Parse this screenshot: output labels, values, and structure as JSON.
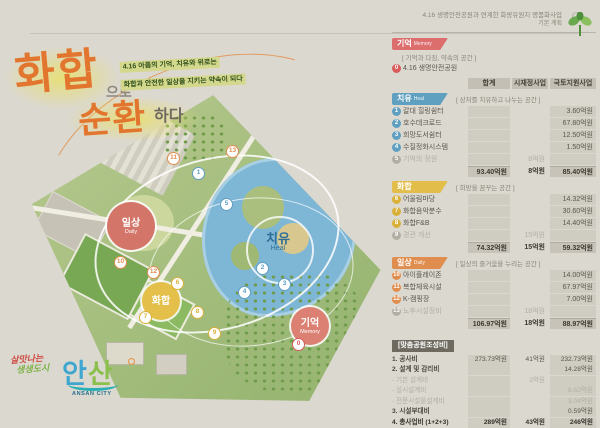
{
  "title": {
    "word1": "화합",
    "particle1": "으로",
    "word2": "순환",
    "particle2": "하다",
    "subtitle_line1": "4.16 아픔의 기억, 치유와 위로는",
    "subtitle_line2": "화합과 안전한 일상을 지키는 약속이 되다"
  },
  "header_note": {
    "line1": "4.16 생명안전공원과 연계한 화랑유원지 명품화사업",
    "line2": "기본 계획"
  },
  "map": {
    "zones": {
      "daily": {
        "label": "일상",
        "eng": "Daily"
      },
      "heal": {
        "label": "치유",
        "eng": "Heal"
      },
      "unity": {
        "label": "화합",
        "eng": ""
      },
      "memory": {
        "label": "기억",
        "eng": "Memory"
      }
    },
    "markers": [
      {
        "n": "0",
        "c": "#d85c5c",
        "x": 297,
        "y": 343
      },
      {
        "n": "1",
        "c": "#5f9fc0",
        "x": 197,
        "y": 172
      },
      {
        "n": "2",
        "c": "#5f9fc0",
        "x": 261,
        "y": 267
      },
      {
        "n": "3",
        "c": "#5f9fc0",
        "x": 283,
        "y": 283
      },
      {
        "n": "4",
        "c": "#5f9fc0",
        "x": 243,
        "y": 291
      },
      {
        "n": "5",
        "c": "#5f9fc0",
        "x": 225,
        "y": 203
      },
      {
        "n": "6",
        "c": "#d9b13a",
        "x": 176,
        "y": 282
      },
      {
        "n": "7",
        "c": "#d9b13a",
        "x": 144,
        "y": 316
      },
      {
        "n": "8",
        "c": "#d9b13a",
        "x": 196,
        "y": 311
      },
      {
        "n": "9",
        "c": "#d9b13a",
        "x": 213,
        "y": 332
      },
      {
        "n": "10",
        "c": "#e08e4f",
        "x": 119,
        "y": 261
      },
      {
        "n": "11",
        "c": "#e08e4f",
        "x": 172,
        "y": 157
      },
      {
        "n": "12",
        "c": "#e08e4f",
        "x": 152,
        "y": 271
      },
      {
        "n": "13",
        "c": "#e08e4f",
        "x": 231,
        "y": 150
      }
    ]
  },
  "logo": {
    "slogan_line1": "살맛나는",
    "slogan_line2": "생생도시",
    "city_char1": "안",
    "city_char2": "산",
    "city_en": "ANSAN CITY"
  },
  "table": {
    "columns": [
      "합계",
      "시재정사업",
      "국토지원사업"
    ],
    "sections": [
      {
        "name": "기억",
        "eng": "Memory",
        "space": "[ 기억과 다짐, 약속의 공간 ]",
        "items": [
          {
            "n": "0",
            "label": "4.16 생명안전공원"
          }
        ]
      },
      {
        "name": "치유",
        "eng": "Heal",
        "space": "[ 상처를 치유하고 나누는 공간 ]",
        "items": [
          {
            "n": "1",
            "label": "갈대 힐링쉼터",
            "national": "3.60억원"
          },
          {
            "n": "2",
            "label": "호수데크로드",
            "national": "67.80억원"
          },
          {
            "n": "3",
            "label": "희망도서쉼터",
            "national": "12.50억원"
          },
          {
            "n": "4",
            "label": "수질정화시스템",
            "national": "1.50억원"
          },
          {
            "n": "5",
            "label": "기억의 정원",
            "city": "8억원"
          }
        ],
        "totals": {
          "total": "93.40억원",
          "city": "8억원",
          "national": "85.40억원"
        }
      },
      {
        "name": "화합",
        "eng": "",
        "space": "[ 희망을 꿈꾸는 공간 ]",
        "items": [
          {
            "n": "6",
            "label": "어울림마당",
            "national": "14.32억원"
          },
          {
            "n": "7",
            "label": "화합음악분수",
            "national": "30.60억원"
          },
          {
            "n": "8",
            "label": "화합F&B",
            "national": "14.40억원"
          },
          {
            "n": "9",
            "label": "경관 개선",
            "city": "15억원"
          }
        ],
        "totals": {
          "total": "74.32억원",
          "city": "15억원",
          "national": "59.32억원"
        }
      },
      {
        "name": "일상",
        "eng": "Daily",
        "space": "[ 일상의 즐거움을 누리는 공간 ]",
        "items": [
          {
            "n": "10",
            "label": "아이플레이존",
            "national": "14.00억원"
          },
          {
            "n": "11",
            "label": "복합체육시설",
            "national": "67.97억원"
          },
          {
            "n": "12",
            "label": "K-캠핑장",
            "national": "7.00억원"
          },
          {
            "n": "13",
            "label": "노후시설정비",
            "city": "18억원"
          }
        ],
        "totals": {
          "total": "106.97억원",
          "city": "18억원",
          "national": "88.97억원"
        }
      }
    ],
    "cost": {
      "header": "[맞춤공원조성비]",
      "rows": [
        {
          "label": "1. 공사비",
          "total": "273.73억원",
          "city": "41억원",
          "national": "232.73억원"
        },
        {
          "label": "2. 설계 및 감리비",
          "national": "14.28억원"
        },
        {
          "label": "- 기본 설계비",
          "city": "2억원"
        },
        {
          "label": "- 실시설계비",
          "national": "8.62억원"
        },
        {
          "label": "- 전문시설물설계비",
          "national": "3.04억원"
        },
        {
          "label": "3. 시설부대비",
          "national": "0.59억원"
        },
        {
          "label": "4. 총사업비 (1+2+3)",
          "total": "289억원",
          "city": "43억원",
          "national": "246억원"
        }
      ]
    }
  },
  "colors": {
    "accent_orange": "#e2762f",
    "memory": "#dc6e6e",
    "heal": "#5f9fc0",
    "unity": "#e3bd4a",
    "daily": "#e08e4f",
    "lake": "#7eb6d6",
    "highlight": "#d4d88c"
  }
}
